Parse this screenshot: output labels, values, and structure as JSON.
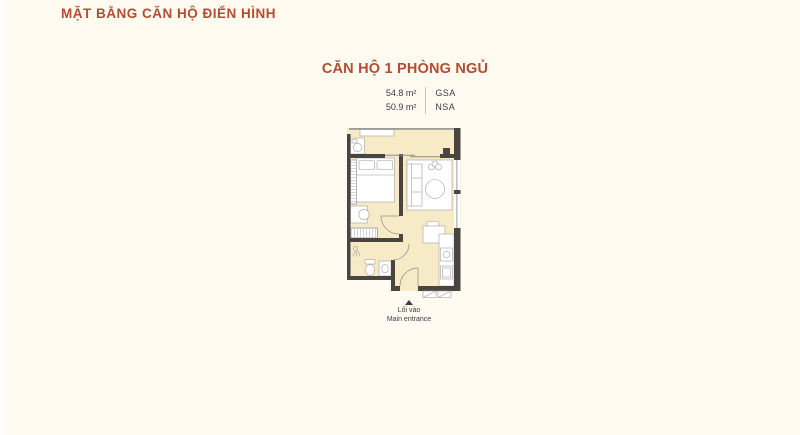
{
  "header": {
    "title": "MẶT BẰNG CĂN HỘ ĐIỂN HÌNH"
  },
  "unit": {
    "name": "CĂN HỘ 1 PHÒNG NGỦ",
    "areas": [
      {
        "value": "54.8 m²",
        "label": "GSA"
      },
      {
        "value": "50.9 m²",
        "label": "NSA"
      }
    ],
    "entrance": {
      "label_vi": "Lối vào",
      "label_en": "Main entrance"
    }
  },
  "colors": {
    "background": "#FFFBF1",
    "accent": "#B34C30",
    "text": "#3C3B45",
    "floor_fill": "#F6EBC6",
    "wall": "#4A4540",
    "furniture_stroke": "#9EA0A2"
  }
}
